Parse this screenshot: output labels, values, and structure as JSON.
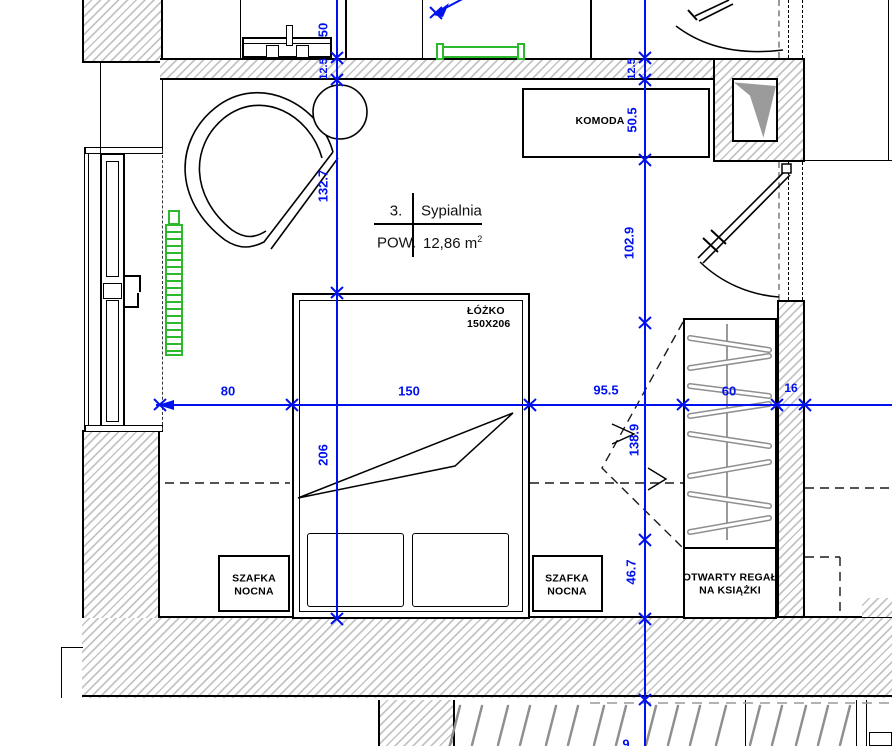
{
  "room": {
    "number": "3.",
    "name": "Sypialnia",
    "area_label": "POW.",
    "area_value": "12,86",
    "area_unit": "m",
    "area_exp": "2"
  },
  "furniture": {
    "komoda": "KOMODA",
    "bed": {
      "line1": "ŁÓŻKO",
      "line2": "150X206"
    },
    "nightstand": {
      "line1": "SZAFKA",
      "line2": "NOCNA"
    },
    "bookshelf": {
      "line1": "OTWARTY REGAŁ",
      "line2": "NA KSIĄŻKI"
    }
  },
  "dimensions": {
    "top_offset": "50",
    "wall_top_left": "12.5",
    "wall_top_right": "12.5",
    "left_upper": "132.7",
    "bed_length": "206",
    "komoda_depth": "50.5",
    "right_upper": "102.9",
    "right_middle": "138.9",
    "right_lower": "46.7",
    "width_left": "80",
    "bed_width": "150",
    "width_right": "95.5",
    "bookshelf_width": "60",
    "wall_right": "16",
    "bottom_partial": "9"
  },
  "colors": {
    "dimension_blue": "#0011f0",
    "radiator_green": "#2db82d",
    "hatch_gray": "#c4c4c4",
    "slat_gray": "#8f8f8f"
  }
}
